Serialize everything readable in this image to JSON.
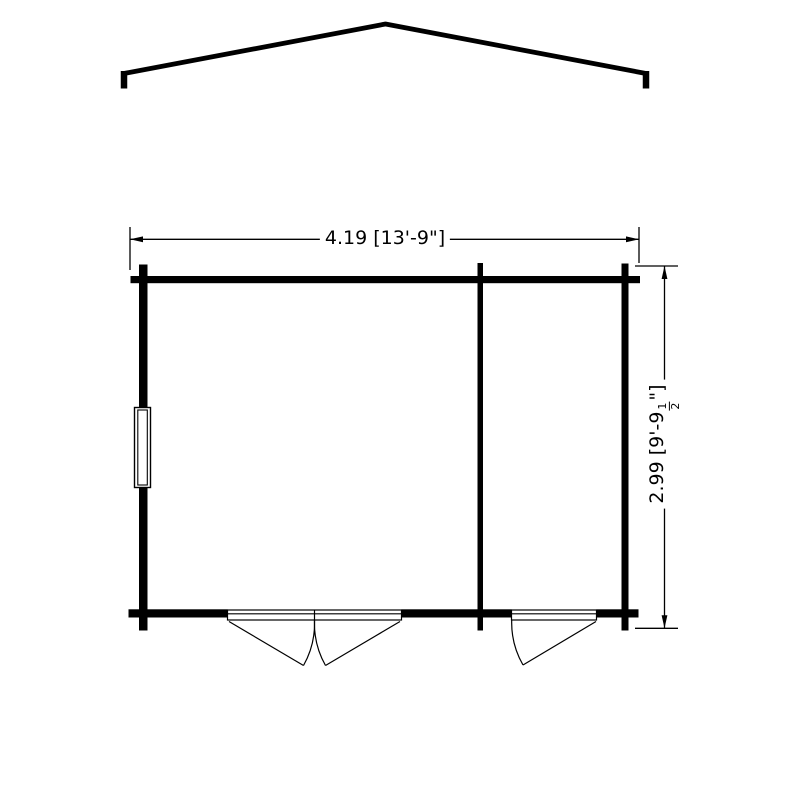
{
  "colors": {
    "line": "#000000",
    "background": "#ffffff"
  },
  "drawing": {
    "type": "floor-plan-with-roof-profile",
    "components": [
      "roof-outline",
      "exterior-walls",
      "partition-wall",
      "window",
      "double-door",
      "single-door"
    ]
  },
  "dimensions": {
    "width": {
      "label": "4.19 [13'-9\"]"
    },
    "depth": {
      "prefix": "2.99 [9'-9",
      "fraction_numerator": "1",
      "fraction_denominator": "2",
      "suffix": "\"]"
    }
  }
}
